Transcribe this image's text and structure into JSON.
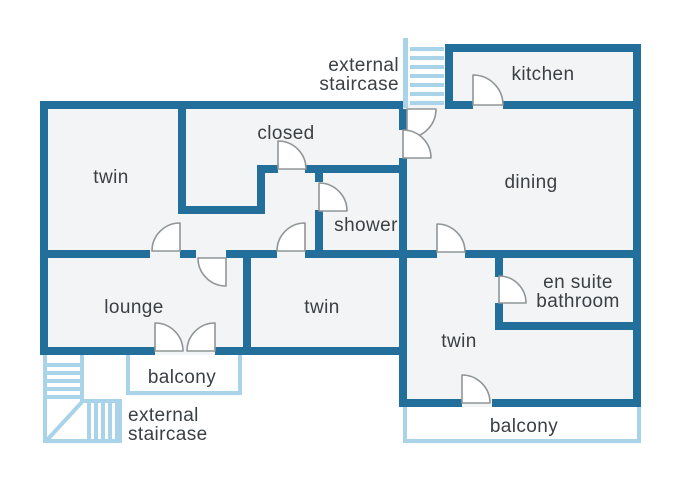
{
  "diagram_type": "apartment floor plan",
  "colors": {
    "wall": "#226f9c",
    "light_blue": "#a8d3e9",
    "room_fill": "#f3f4f5",
    "label_text": "#3b4045",
    "door_stroke": "#909597",
    "background": "#ffffff"
  },
  "rooms": {
    "twin_tl": {
      "label": "twin"
    },
    "closed": {
      "label": "closed"
    },
    "shower": {
      "label": "shower"
    },
    "kitchen": {
      "label": "kitchen"
    },
    "dining": {
      "label": "dining"
    },
    "lounge": {
      "label": "lounge"
    },
    "twin_mid": {
      "label": "twin"
    },
    "twin_br": {
      "label": "twin"
    },
    "ensuite": {
      "label_line1": "en suite",
      "label_line2": "bathroom"
    }
  },
  "outdoor": {
    "balcony_left": {
      "label": "balcony"
    },
    "balcony_right": {
      "label": "balcony"
    },
    "staircase_top": {
      "label_line1": "external",
      "label_line2": "staircase"
    },
    "staircase_bottom": {
      "label_line1": "external",
      "label_line2": "staircase"
    }
  }
}
